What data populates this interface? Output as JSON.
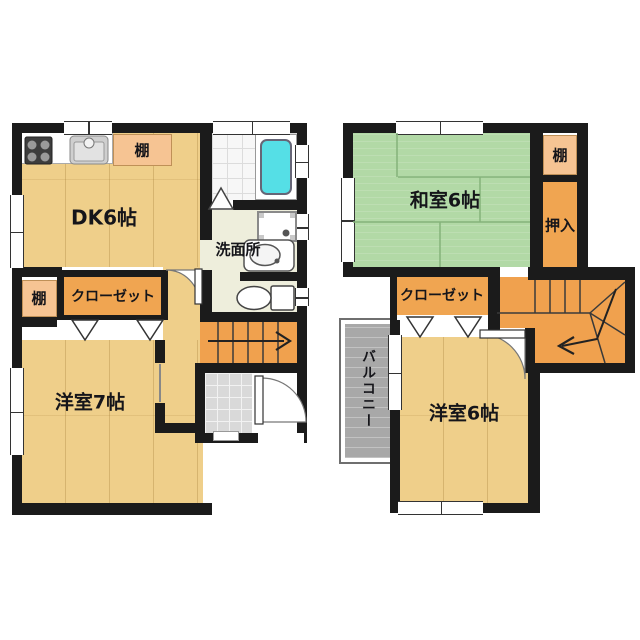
{
  "floor1": {
    "dk_label": "DK6帖",
    "shelf_top_label": "棚",
    "shelf_side_label": "棚",
    "closet_label": "クローゼット",
    "washroom_label": "洗面所",
    "western_room_label": "洋室7帖"
  },
  "floor2": {
    "japanese_room_label": "和室6帖",
    "shelf_label": "棚",
    "oshiire_label": "押入",
    "closet_label": "クローゼット",
    "western_room_label": "洋室6帖",
    "balcony_label": "バルコニー"
  },
  "colors": {
    "wall": "#1b1b1b",
    "wood_floor": "#efcf8a",
    "tatami": "#b2d9a6",
    "closet_fill": "#f0a551",
    "shelf_fill": "#f6c493",
    "stairs_fill": "#f0a14e",
    "washroom_floor": "#eeeedc",
    "bathtub": "#55dfe6",
    "entrance_tile": "#d9d9d9",
    "balcony": "#a8a8a8"
  },
  "icons": {
    "stove": "gas-stove-icon",
    "kitchen_sink": "kitchen-sink-icon",
    "bathtub": "bathtub-icon",
    "washing_machine": "washing-machine-icon",
    "wash_basin": "wash-basin-icon",
    "toilet": "toilet-icon",
    "stairs_up_arrow": "arrow-right",
    "stairs_down_arrow": "arrow-down-left",
    "doors": "swing-door-arc"
  }
}
